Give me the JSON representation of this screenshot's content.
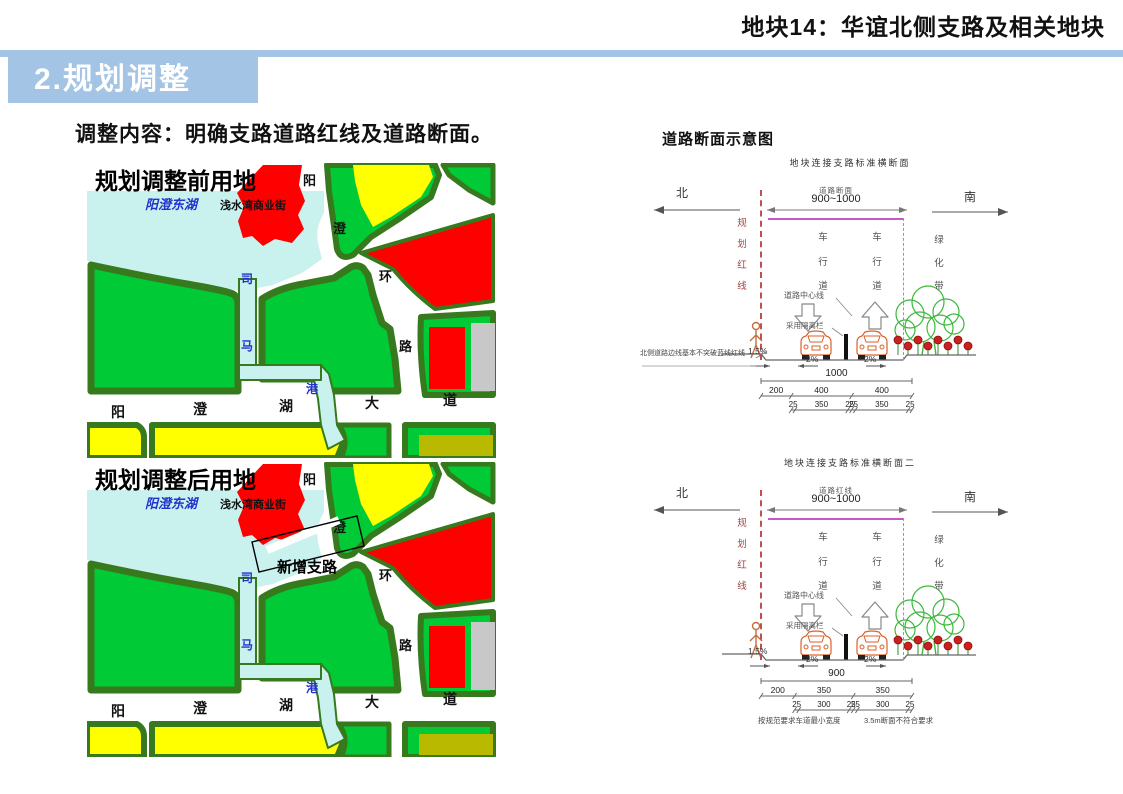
{
  "header": {
    "title": "地块14：华谊北侧支路及相关地块"
  },
  "banner": {
    "title": "2.规划调整"
  },
  "intro": {
    "text": "调整内容：明确支路道路红线及道路断面。"
  },
  "right_panel": {
    "title": "道路断面示意图"
  },
  "colors": {
    "banner_blue": "#A3C4E4",
    "map_green": "#00CA36",
    "map_border_green": "#37791D",
    "lake_cyan": "#C9F2EF",
    "red": "#FF0000",
    "yellow": "#FFFF00",
    "gray": "#C8C8C8",
    "olive": "#B9B900",
    "map_text_blue": "#2233CC",
    "redline_dash": "#C0504D",
    "magenta": "#C757C7",
    "car_orange": "#D9622B",
    "tree_green": "#3CB83C",
    "flower_red": "#CC2020"
  },
  "maps": {
    "shared_labels": {
      "lake": "阳澄东湖",
      "commercial_street": "浅水湾商业街",
      "ring_road": [
        "阳",
        "澄",
        "环",
        "路"
      ],
      "avenue": [
        "阳",
        "澄",
        "湖",
        "大",
        "道"
      ],
      "river": [
        "司",
        "马",
        "港"
      ]
    },
    "before": {
      "title": "规划调整前用地"
    },
    "after": {
      "title": "规划调整后用地",
      "new_road_label": "新增支路"
    }
  },
  "cross_sections": [
    {
      "title": "地块连接支路标准横断面",
      "direction_left": "北",
      "direction_right": "南",
      "red_line_label": "规划红线",
      "width_caption": "道路断面",
      "width_value": "900~1000",
      "lane_labels": [
        "车行道",
        "车行道"
      ],
      "green_belt_label": "绿化带",
      "centerline_label": "道路中心线",
      "barrier_label": "采用隔离栏",
      "slopes": [
        "1.5%",
        "2%",
        "2%"
      ],
      "dim_total": "1000",
      "dim_segments": [
        "200",
        "400",
        "400"
      ],
      "dim_sub_segments": [
        "25",
        "350",
        "25",
        "25",
        "350",
        "25"
      ],
      "side_note": "北侧道路边线基本不突破蓝线红线"
    },
    {
      "title": "地块连接支路标准横断面二",
      "direction_left": "北",
      "direction_right": "南",
      "red_line_label": "规划红线",
      "width_caption": "道路红线",
      "width_value": "900~1000",
      "lane_labels": [
        "车行道",
        "车行道"
      ],
      "green_belt_label": "绿化带",
      "centerline_label": "道路中心线",
      "barrier_label": "采用隔离栏",
      "slopes": [
        "1.5%",
        "2%",
        "2%"
      ],
      "dim_total": "900",
      "dim_segments": [
        "200",
        "350",
        "350"
      ],
      "dim_sub_segments": [
        "25",
        "300",
        "25",
        "25",
        "300",
        "25"
      ],
      "bottom_notes": [
        "按规范要求车道最小宽度",
        "3.5m断面不符合要求"
      ]
    }
  ]
}
